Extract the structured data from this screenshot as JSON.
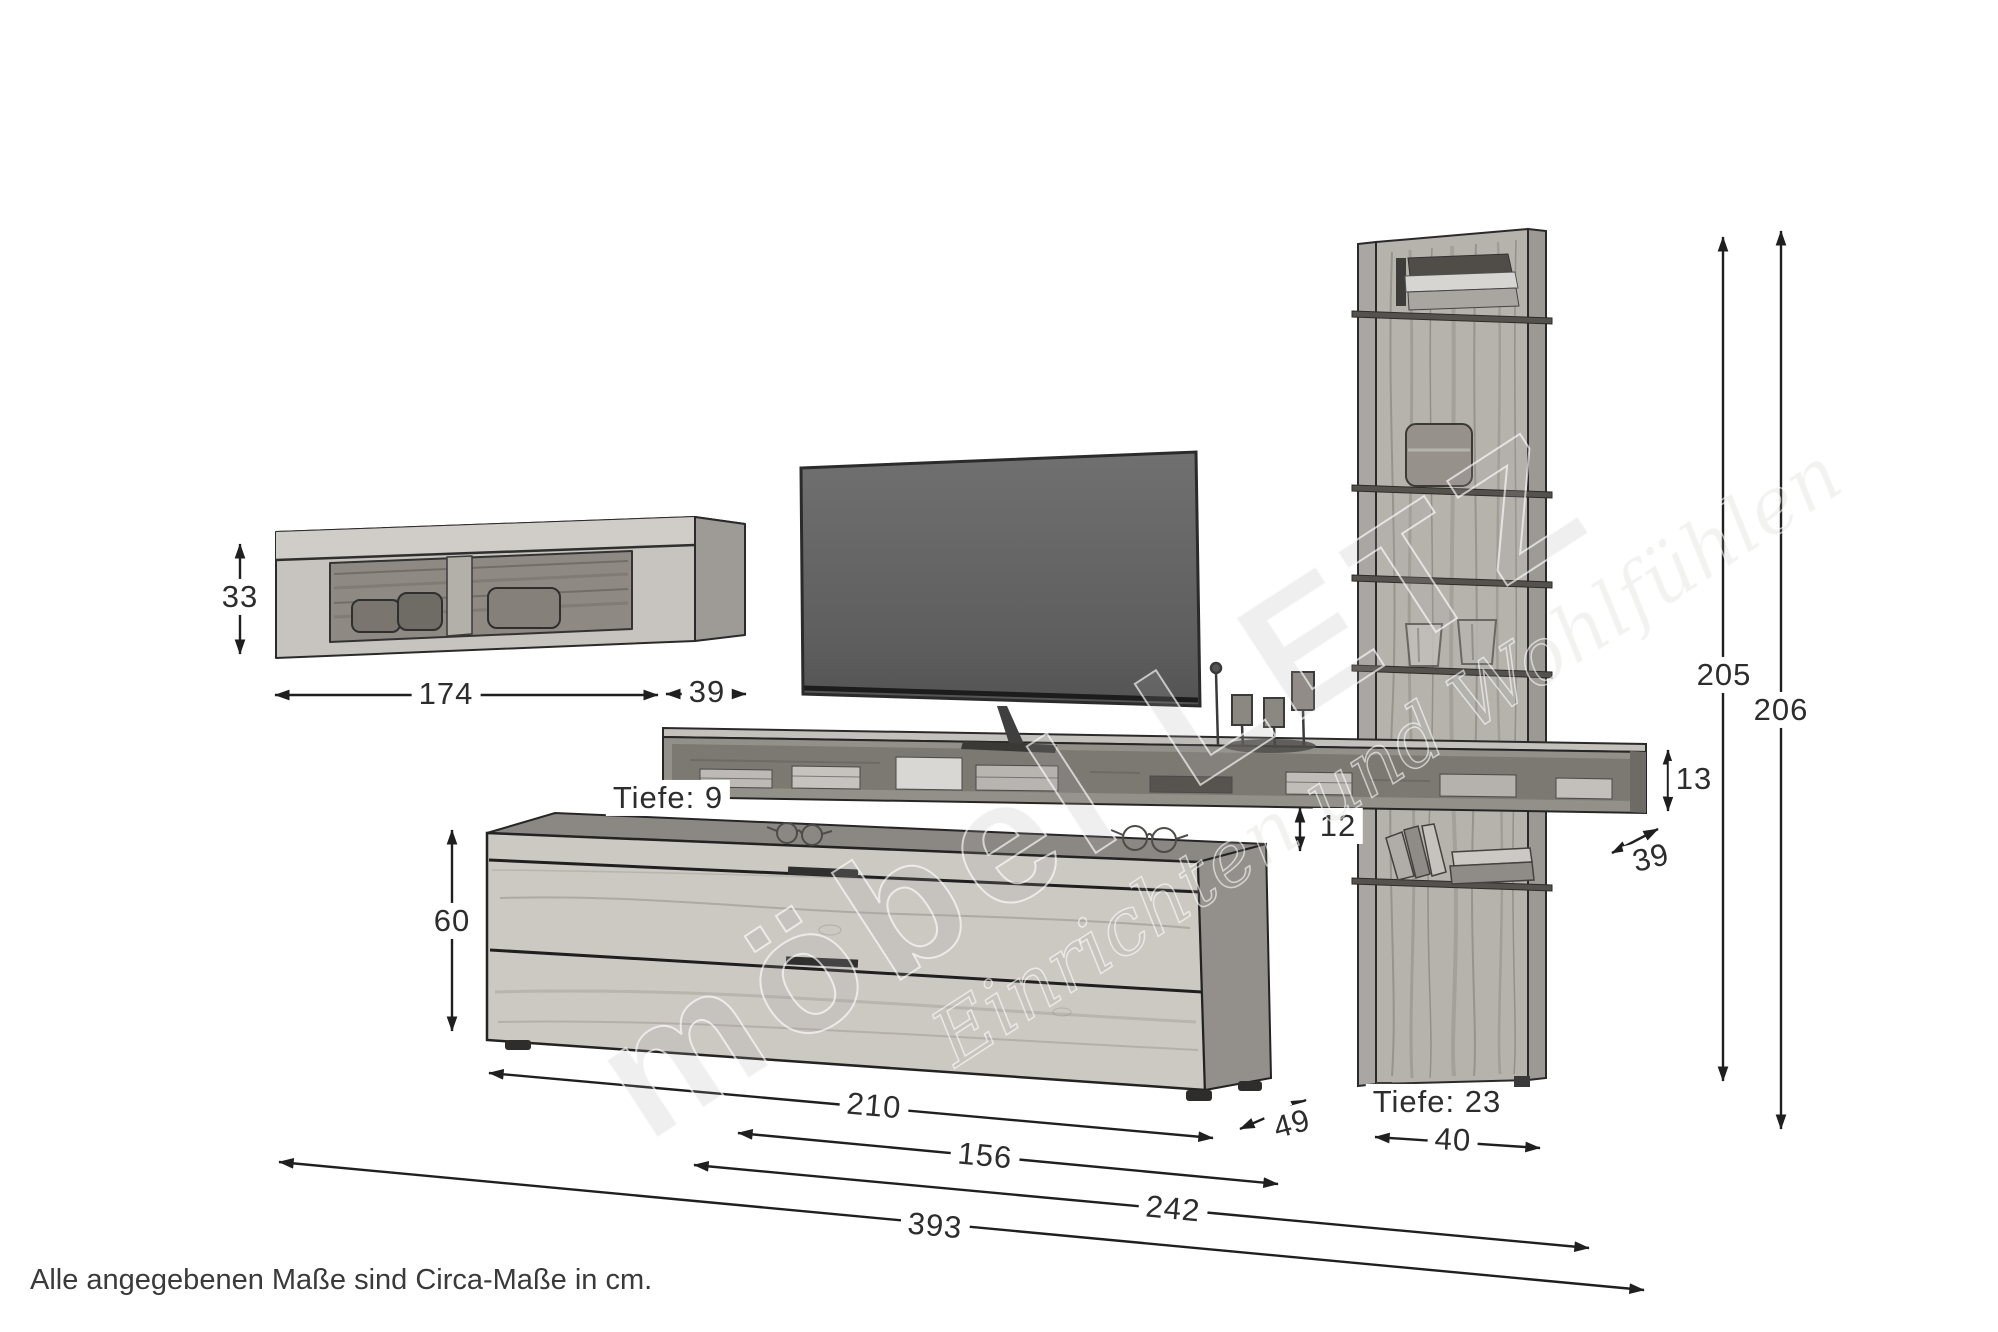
{
  "page": {
    "note": "Alle angegebenen Maße sind Circa-Maße in cm."
  },
  "watermark": {
    "brand": "möbel LETZ",
    "slogan": "Einrichten und Wohlfühlen"
  },
  "dimensions": {
    "hanging_cabinet": {
      "height": "33",
      "width": "174",
      "depth": "39"
    },
    "media_board": {
      "depth_label": "Tiefe: 9",
      "height": "13",
      "depth": "39",
      "gap_to_lowboard": "12"
    },
    "wall_panel": {
      "height": "205",
      "total_height": "206",
      "depth_label": "Tiefe: 23",
      "width": "40"
    },
    "lowboard": {
      "height": "60",
      "width": "210",
      "inner_width": "156",
      "depth": "49"
    },
    "combination": {
      "width_with_panel": "242",
      "total_width": "393"
    }
  },
  "colors": {
    "line": "#1f1f1f",
    "label_text": "#2d2d2d",
    "wood_light": "#ccc9c3",
    "wood_medium": "#a9a6a1",
    "wood_dark": "#8d8984",
    "tv_screen": "#666666"
  }
}
